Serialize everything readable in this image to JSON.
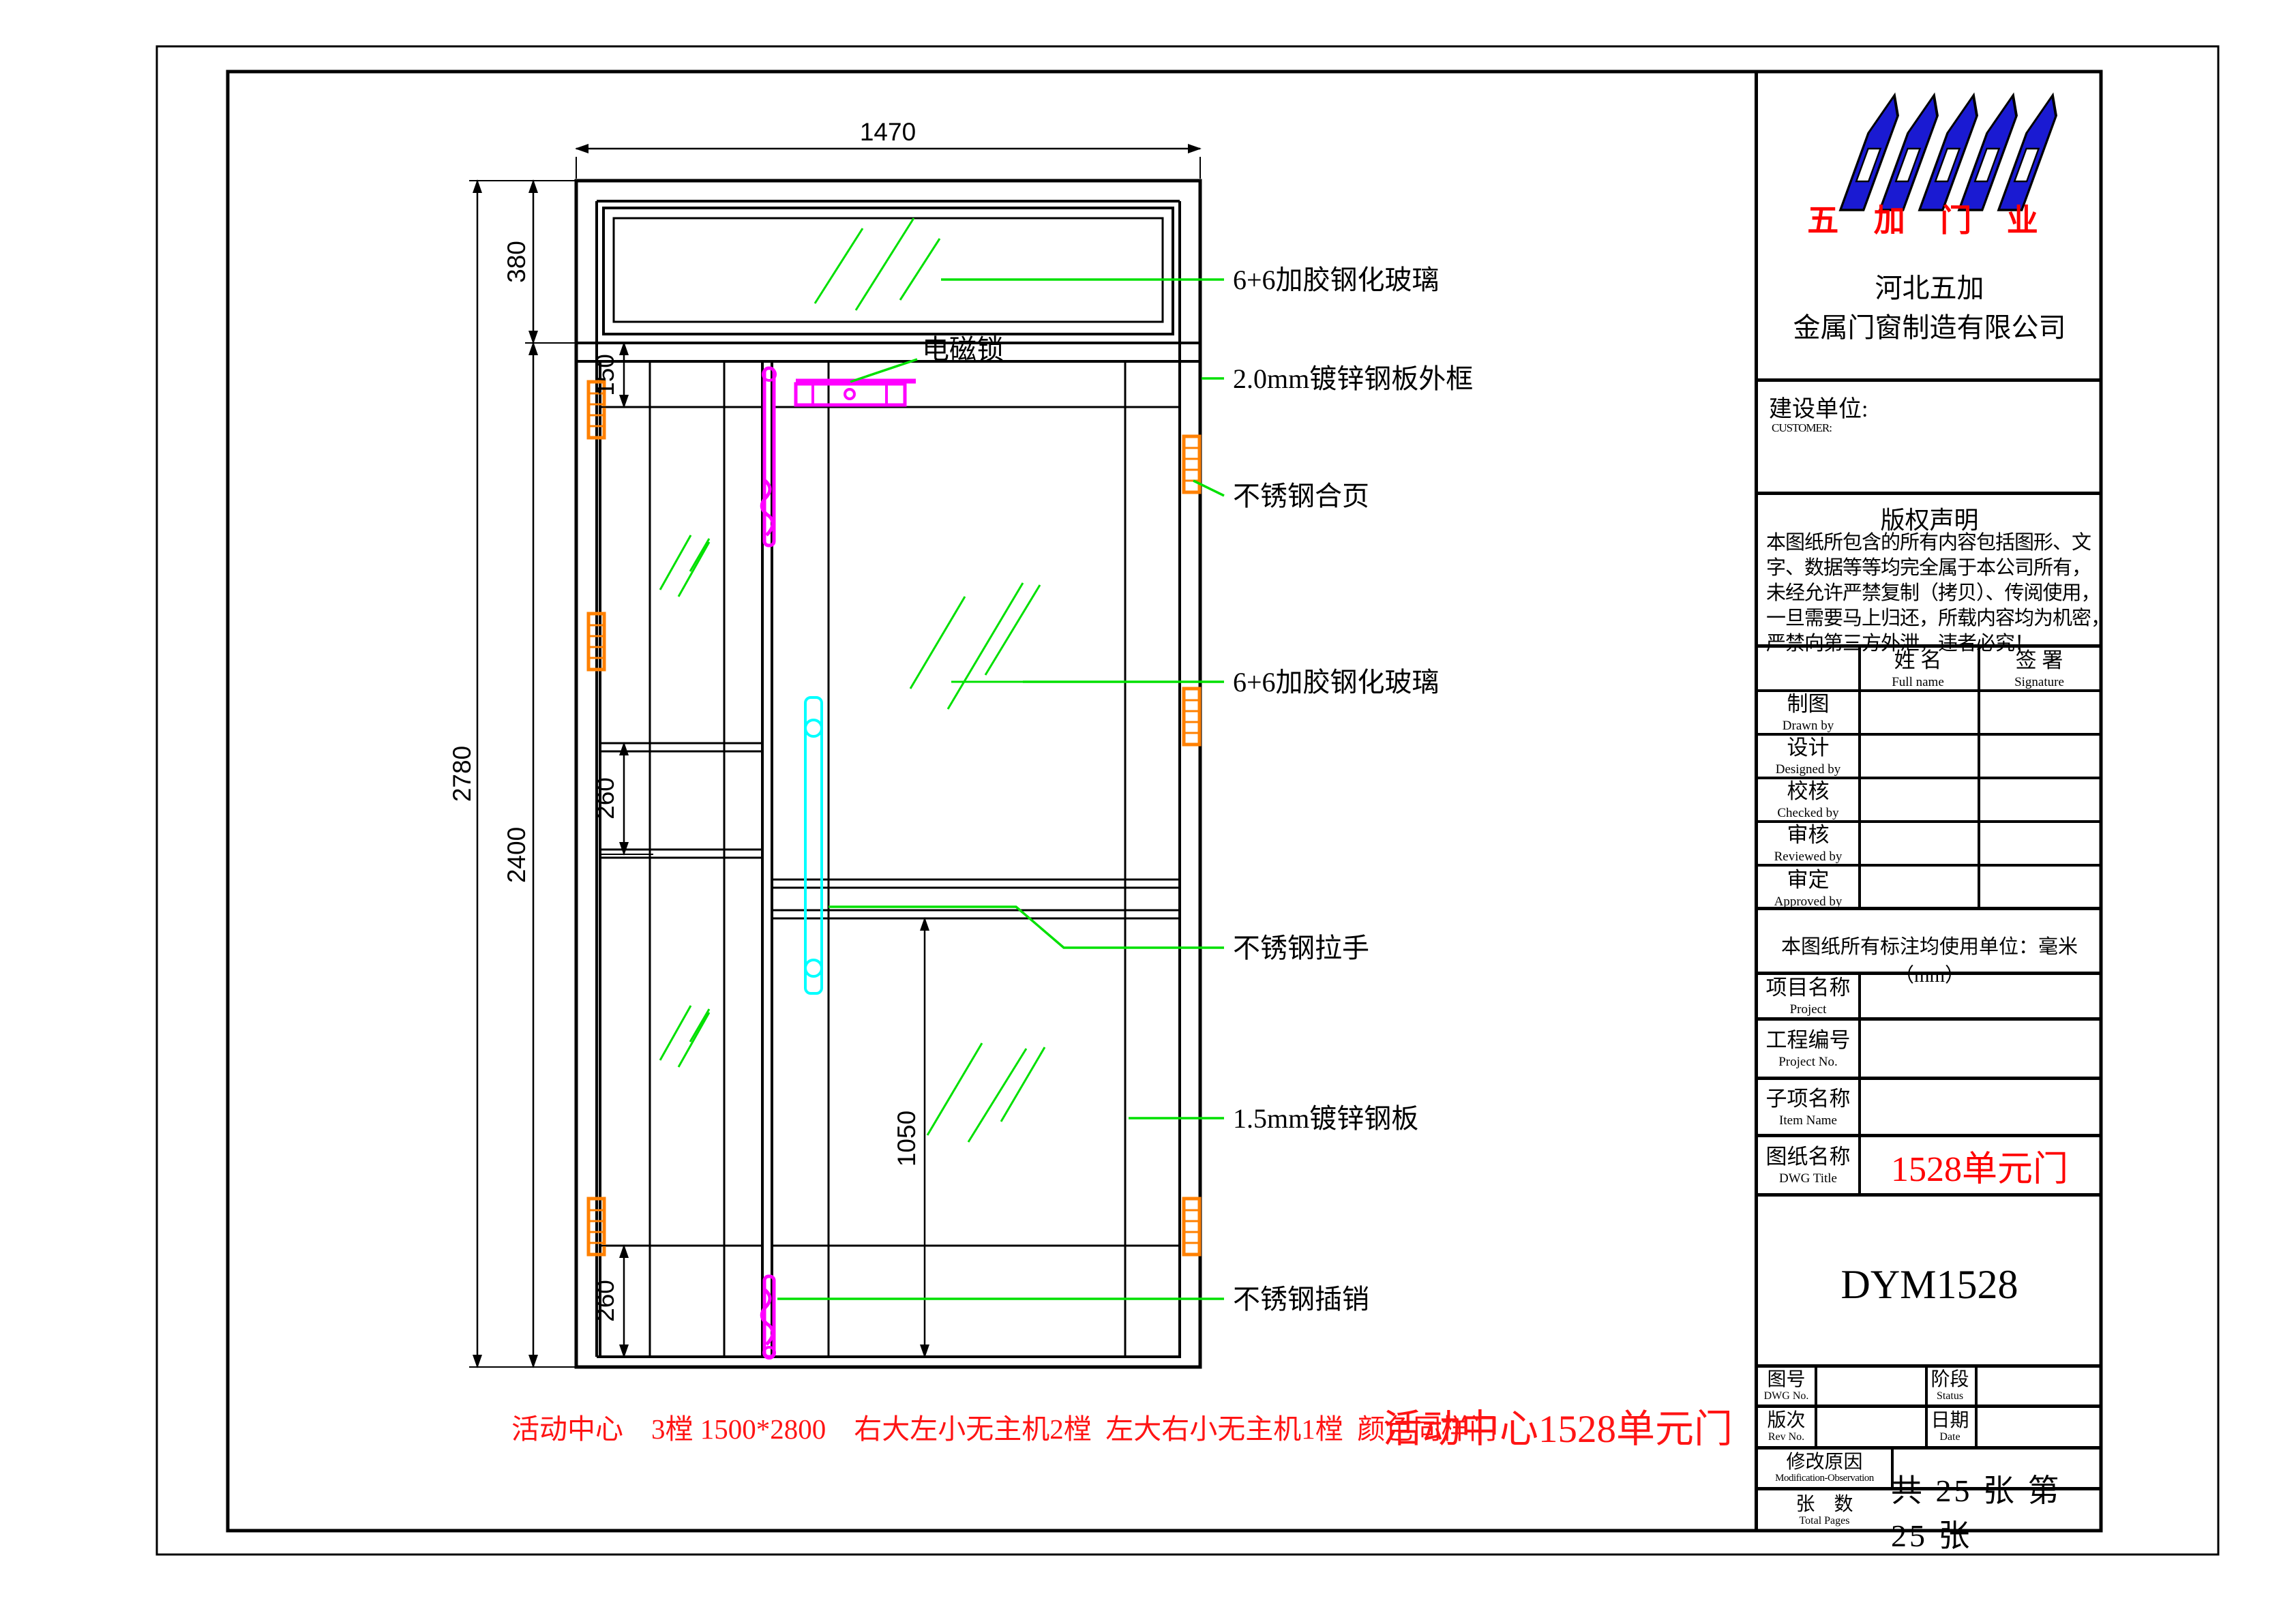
{
  "drawing": {
    "dims": {
      "width": "1470",
      "overall_height": "2780",
      "opening_height": "2400",
      "transom_height": "380",
      "top_rail": "150",
      "mid_rail": "260",
      "bottom_rail": "260",
      "lower_panel": "1050"
    },
    "annotations": {
      "maglock": "电磁锁",
      "glass_top": "6+6加胶钢化玻璃",
      "outer_frame": "2.0mm镀锌钢板外框",
      "hinge": "不锈钢合页",
      "glass_main": "6+6加胶钢化玻璃",
      "handle": "不锈钢拉手",
      "steel_panel": "1.5mm镀锌钢板",
      "flush_bolt": "不锈钢插销"
    },
    "colors": {
      "leader_green": "#00e000",
      "hardware_magenta": "#ff00ff",
      "handle_cyan": "#00ffff",
      "hinge_orange": "#ff8000"
    }
  },
  "notes": {
    "left": "活动中心    3樘 1500*2800    右大左小无主机2樘  左大右小无主机1樘  颜色同样门",
    "right": "活动中心1528单元门"
  },
  "title_block": {
    "brand": "五 加 门 业",
    "company_line1": "河北五加",
    "company_line2": "金属门窗制造有限公司",
    "customer_label": "建设单位:",
    "customer_label_en": "CUSTOMER:",
    "copyright_title": "版权声明",
    "copyright_lines": [
      "本图纸所包含的所有内容包括图形、文",
      "字、数据等等均完全属于本公司所有，",
      "未经允许严禁复制（拷贝）、传阅使用，",
      "一旦需要马上归还，所载内容均为机密，",
      "严禁向第三方外泄，违者必究！"
    ],
    "col_name_cn": "姓  名",
    "col_name_en": "Full name",
    "col_sign_cn": "签  署",
    "col_sign_en": "Signature",
    "signature_rows": [
      {
        "cn": "制图",
        "en": "Drawn by"
      },
      {
        "cn": "设计",
        "en": "Designed by"
      },
      {
        "cn": "校核",
        "en": "Checked by"
      },
      {
        "cn": "审核",
        "en": "Reviewed by"
      },
      {
        "cn": "审定",
        "en": "Approved by"
      }
    ],
    "units_note": "本图纸所有标注均使用单位：毫米（mm）",
    "fields": [
      {
        "cn": "项目名称",
        "en": "Project",
        "value": ""
      },
      {
        "cn": "工程编号",
        "en": "Project No.",
        "value": ""
      },
      {
        "cn": "子项名称",
        "en": "Item Name",
        "value": ""
      },
      {
        "cn": "图纸名称",
        "en": "DWG Title",
        "value": "1528单元门"
      }
    ],
    "model": "DYM1528",
    "grid": {
      "dwg_no_cn": "图号",
      "dwg_no_en": "DWG No.",
      "status_cn": "阶段",
      "status_en": "Status",
      "rev_cn": "版次",
      "rev_en": "Rev No.",
      "date_cn": "日期",
      "date_en": "Date",
      "mod_cn": "修改原因",
      "mod_en": "Modification-Observation",
      "pages_cn": "张    数",
      "pages_en": "Total Pages",
      "pages_value": "共 25 张 第 25 张"
    }
  }
}
